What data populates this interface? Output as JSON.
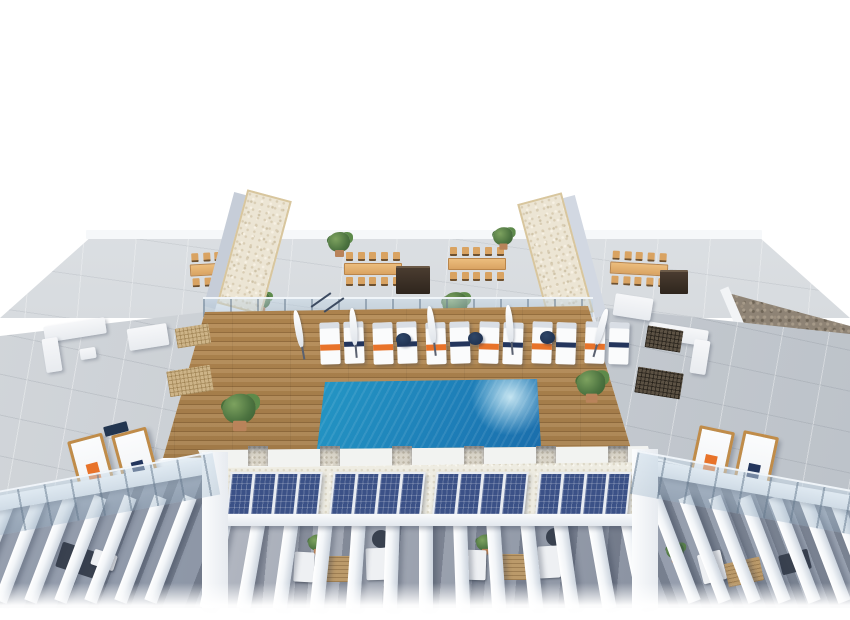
{
  "scene": {
    "type": "architectural-3d-render",
    "subject": "aerial view of residential rooftop solarium with swimming pool, wooden sun deck, stair towers, dining terraces, solar panels and pergola-covered terraces",
    "background_color": "#ffffff"
  },
  "colors": {
    "background_color": "#ffffff",
    "pool_shallow": "#3ec3dc",
    "pool_deep": "#143f82",
    "deck_wood": "#b68a52",
    "concrete": "#c6cbd1",
    "tower_trim": "#d8c69e",
    "towel_orange": "#e8732a",
    "navy": "#23355c",
    "solar_panel": "#3b5187",
    "wood_furniture": "#d9a362",
    "lounger_frame": "#c08c49",
    "plant_green": "#4c7340",
    "gravel_brown": "#8e8375",
    "pergola_shade": "#8b93a2",
    "glass_tint": "rgba(173,196,214,0.38)"
  },
  "counts": {
    "stair_towers": 2,
    "pool_lounger_pairs": 6,
    "parasols": 5,
    "pool_side_tables": 3,
    "dining_sets": 4,
    "dining_chairs_per_side": 5,
    "solar_arrays": 4,
    "solar_panels_per_array": 4,
    "deck_piers": 6,
    "pergola_beams_left": 7,
    "pergola_beams_center": 13,
    "pergola_beams_right": 7,
    "wing_wooden_loungers_per_side": 2,
    "deck_potted_plants": 2
  }
}
